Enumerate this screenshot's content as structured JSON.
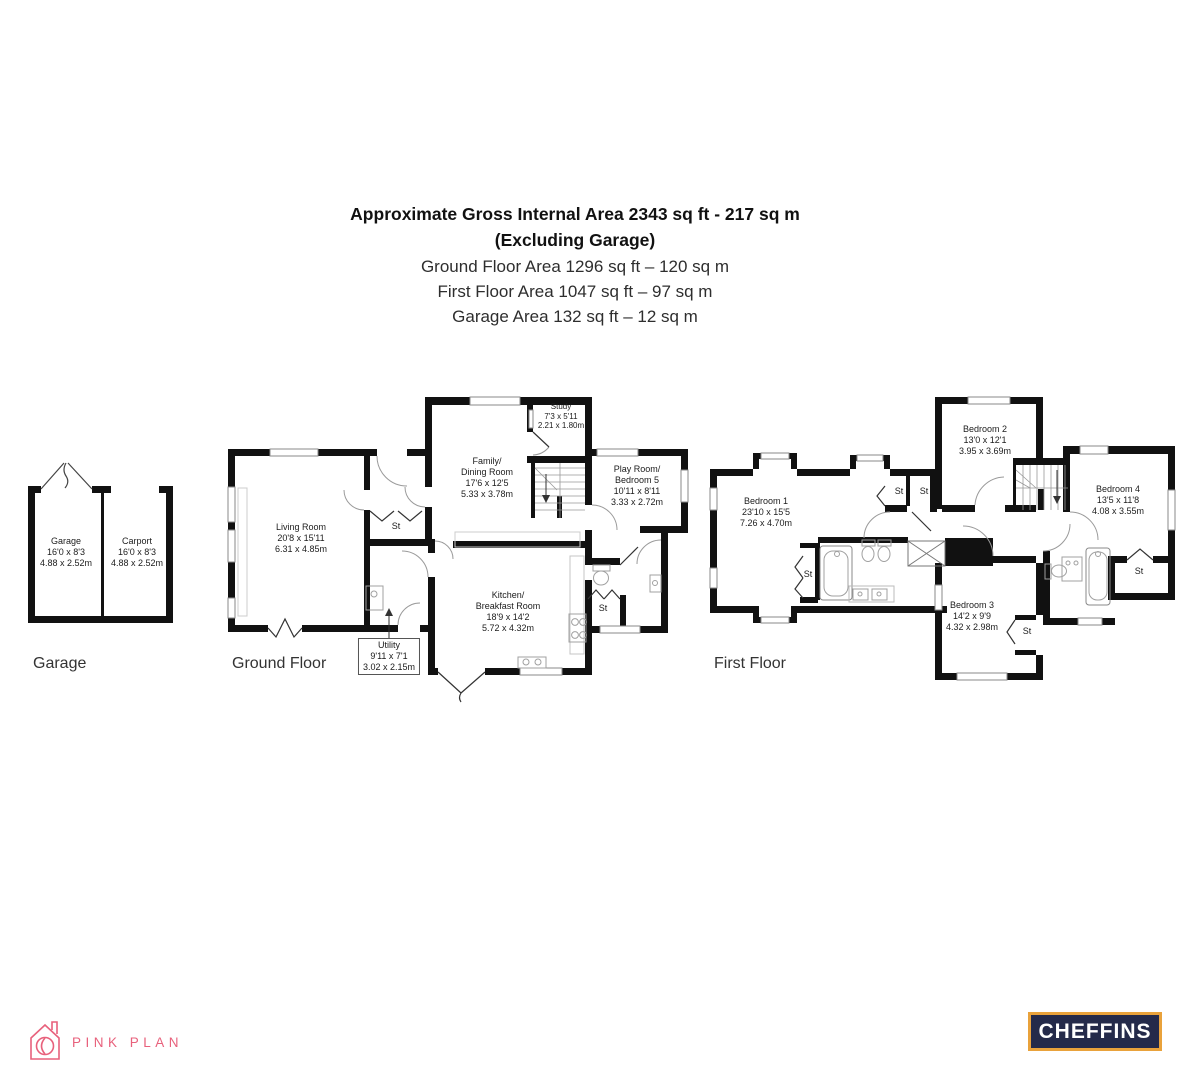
{
  "header": {
    "line1": "Approximate Gross Internal Area 2343 sq ft - 217 sq m",
    "line2": "(Excluding Garage)",
    "line3": "Ground Floor Area 1296 sq ft – 120 sq m",
    "line4": "First Floor Area 1047 sq ft – 97 sq m",
    "line5": "Garage Area 132 sq ft – 12 sq m"
  },
  "plans": {
    "garage": {
      "label": "Garage",
      "rooms": {
        "garage": {
          "name": "Garage",
          "imperial": "16'0 x 8'3",
          "metric": "4.88 x 2.52m"
        },
        "carport": {
          "name": "Carport",
          "imperial": "16'0 x 8'3",
          "metric": "4.88 x 2.52m"
        }
      }
    },
    "ground": {
      "label": "Ground Floor",
      "rooms": {
        "living": {
          "name": "Living Room",
          "imperial": "20'8 x 15'11",
          "metric": "6.31 x 4.85m"
        },
        "family": {
          "name1": "Family/",
          "name2": "Dining Room",
          "imperial": "17'6 x 12'5",
          "metric": "5.33 x 3.78m"
        },
        "study": {
          "name": "Study",
          "imperial": "7'3 x 5'11",
          "metric": "2.21 x 1.80m"
        },
        "play": {
          "name1": "Play Room/",
          "name2": "Bedroom 5",
          "imperial": "10'11 x 8'11",
          "metric": "3.33 x 2.72m"
        },
        "kitchen": {
          "name1": "Kitchen/",
          "name2": "Breakfast Room",
          "imperial": "18'9 x 14'2",
          "metric": "5.72 x 4.32m"
        },
        "utility": {
          "name": "Utility",
          "imperial": "9'11 x 7'1",
          "metric": "3.02 x 2.15m"
        },
        "st_hall": "St",
        "st_wc": "St"
      }
    },
    "first": {
      "label": "First Floor",
      "rooms": {
        "bedroom1": {
          "name": "Bedroom 1",
          "imperial": "23'10 x 15'5",
          "metric": "7.26 x 4.70m"
        },
        "bedroom2": {
          "name": "Bedroom 2",
          "imperial": "13'0 x 12'1",
          "metric": "3.95 x 3.69m"
        },
        "bedroom3": {
          "name": "Bedroom 3",
          "imperial": "14'2 x 9'9",
          "metric": "4.32 x 2.98m"
        },
        "bedroom4": {
          "name": "Bedroom 4",
          "imperial": "13'5 x 11'8",
          "metric": "4.08 x 3.55m"
        },
        "st_a": "St",
        "st_b": "St",
        "st_c": "St",
        "st_d": "St",
        "st_e": "St"
      }
    }
  },
  "logos": {
    "pink_plan": {
      "text": "PINK PLAN",
      "color": "#e8617c"
    },
    "cheffins": {
      "text": "CHEFFINS",
      "bg": "#242a4a",
      "border": "#e9a23b"
    }
  },
  "colors": {
    "wall": "#111111",
    "fixture": "#999999",
    "window_line": "#8a8a8a"
  }
}
